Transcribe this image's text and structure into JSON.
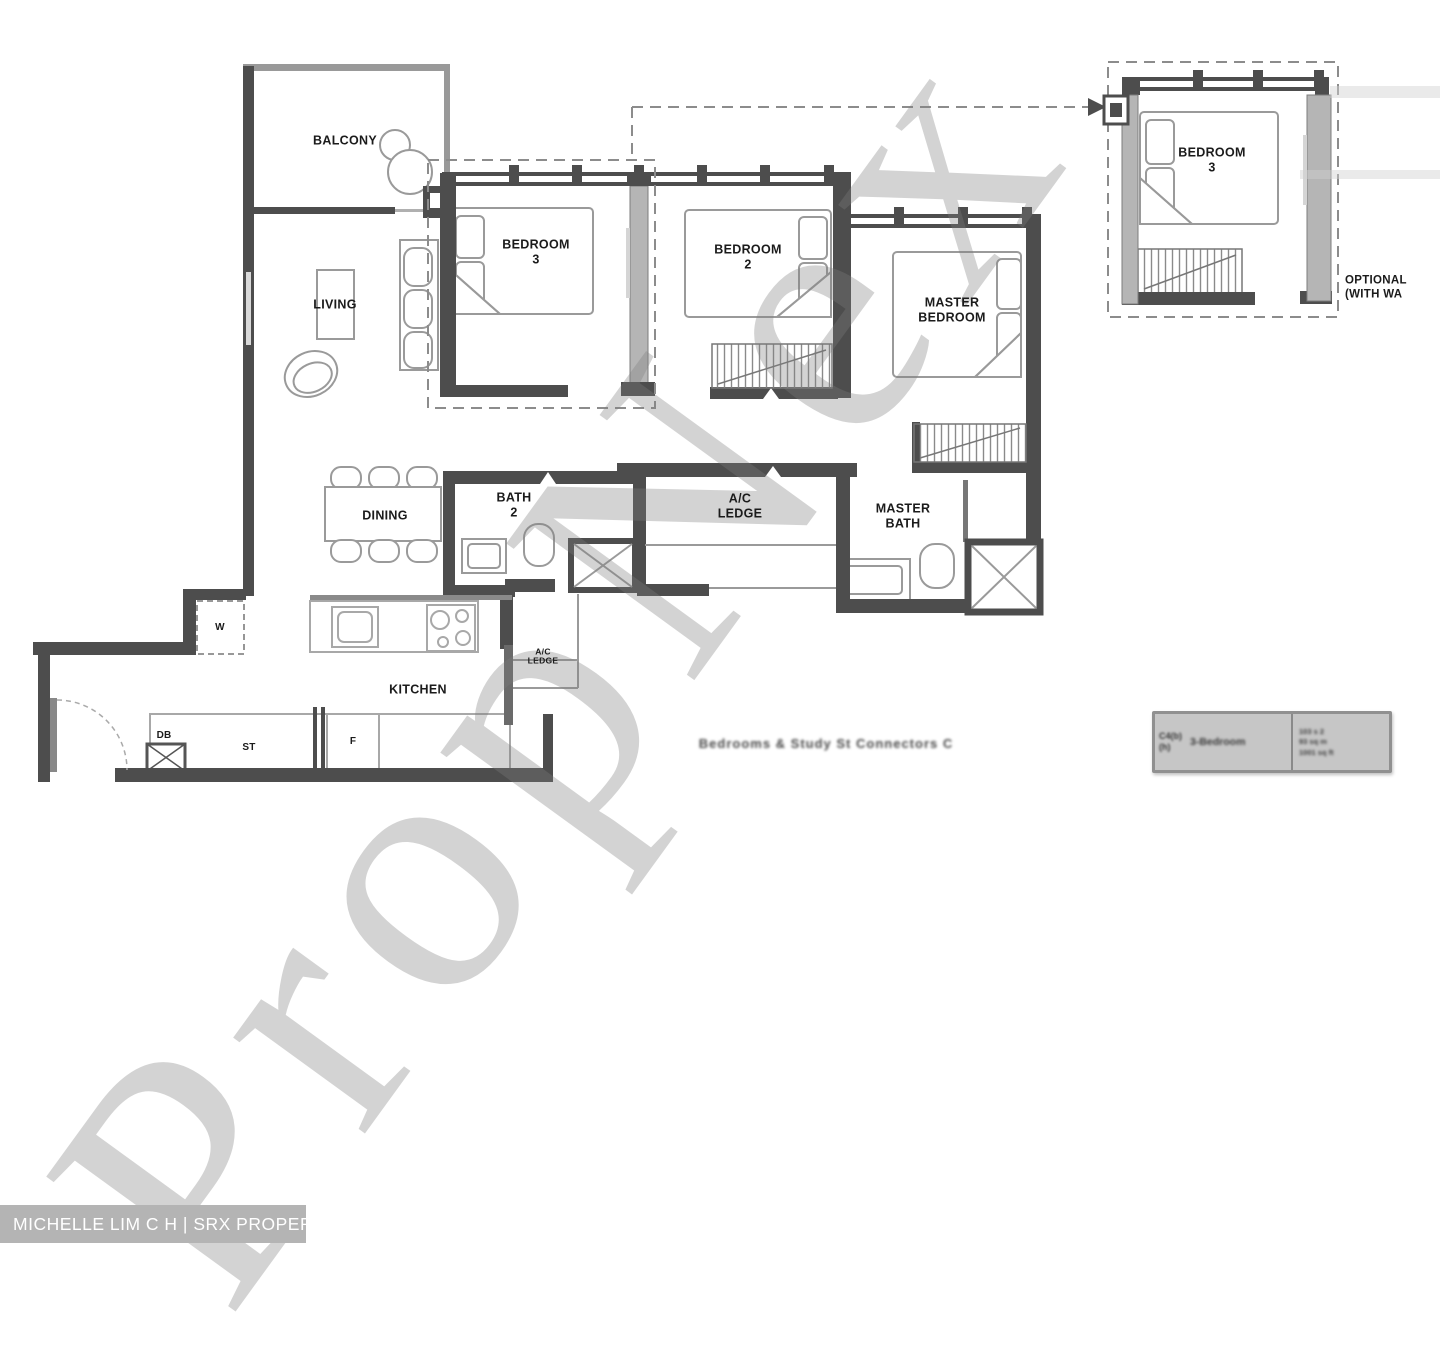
{
  "watermark": {
    "text": "PropNex"
  },
  "agent_bar": {
    "text": "MICHELLE LIM C H | SRX PROPERTY"
  },
  "rooms": {
    "balcony": "BALCONY",
    "living": "LIVING",
    "dining": "DINING",
    "kitchen": "KITCHEN",
    "bedroom3": "BEDROOM\n3",
    "bedroom2": "BEDROOM\n2",
    "master_bedroom": "MASTER\nBEDROOM",
    "bath2": "BATH\n2",
    "master_bath": "MASTER\nBATH",
    "ac_ledge": "A/C\nLEDGE",
    "ac_ledge_small": "A/C\nLEDGE",
    "optional_bedroom3": "BEDROOM\n3"
  },
  "small_labels": {
    "washer": "W",
    "db": "DB",
    "store": "ST",
    "fridge": "F"
  },
  "optional_note": "OPTIONAL\n(WITH WA",
  "caption": "Bedrooms & Study  St Connectors C",
  "info_box": {
    "code": "C4(b)",
    "code2": "(h)",
    "name": "3-Bedroom",
    "area_lines": [
      "103 s 2",
      "93 sq m",
      "1001 sq ft"
    ]
  },
  "colors": {
    "wall": "#4d4d4d",
    "gray_wall": "#b5b5b5",
    "furniture_line": "#9a9a9a",
    "dash_line": "#8c8c8c",
    "info_box_bg": "#c6c6c6",
    "agent_bar_bg": "#b4b4b4"
  }
}
